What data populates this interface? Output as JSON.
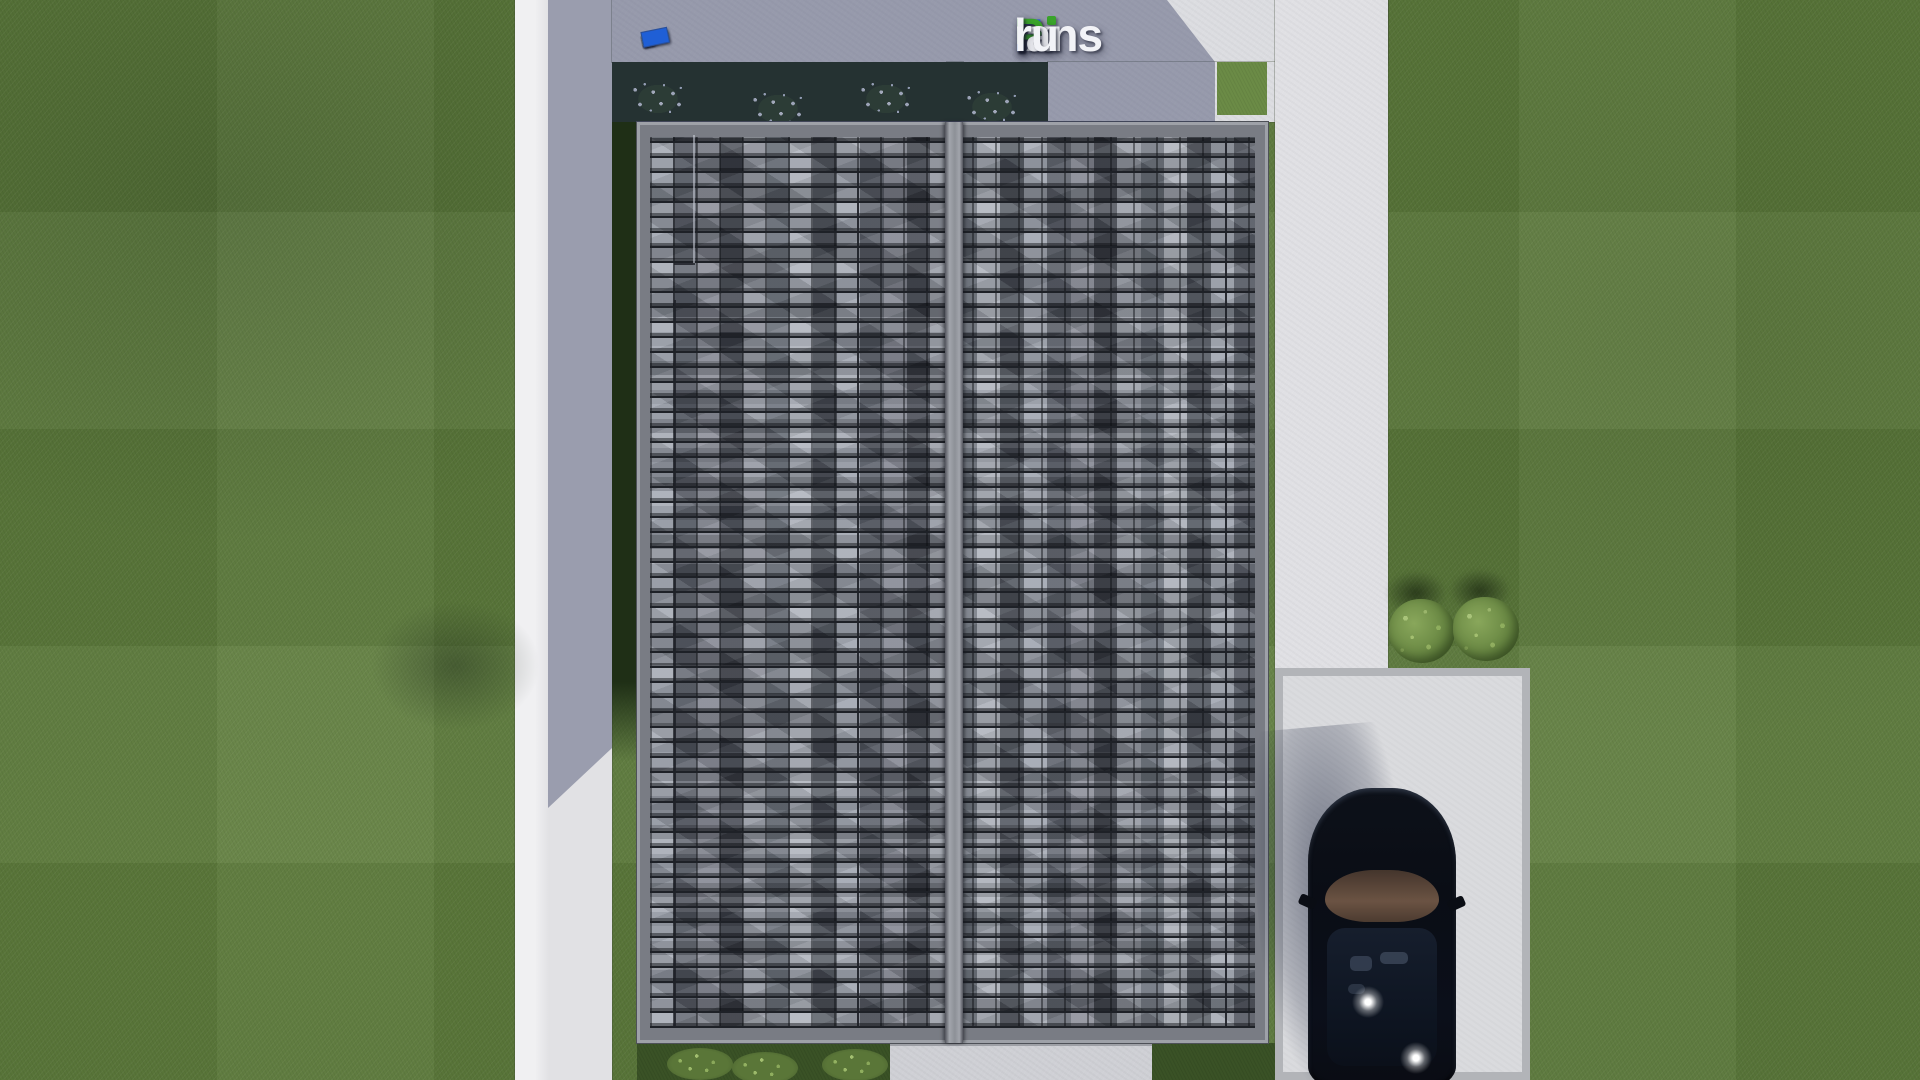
{
  "watermark": {
    "text": "FixPlans.ru",
    "parts": [
      {
        "text": "F",
        "color": "#2b62d9"
      },
      {
        "text": "ix",
        "color": "#f2f3f7"
      },
      {
        "text": "P",
        "color": "#3aa32b"
      },
      {
        "text": "lans",
        "color": "#f2f3f7"
      },
      {
        "text": ".",
        "color": "#2b6fe3"
      },
      {
        "text": "ru",
        "color": "#f2f3f7"
      }
    ],
    "i_dot_color": "#3aa32b"
  },
  "scale_bar": {
    "blocks": [
      {
        "w": 10,
        "h": 11,
        "color": "#e9ebef"
      },
      {
        "w": 10,
        "h": 11,
        "color": "#dde0e6"
      },
      {
        "w": 10,
        "h": 11,
        "color": "#e9ebef"
      },
      {
        "w": 10,
        "h": 11,
        "color": "#e2e5ea"
      },
      {
        "w": 11,
        "h": 11,
        "color": "#1f5fd6"
      },
      {
        "w": 24,
        "h": 11,
        "color": "#e9ebef"
      },
      {
        "w": 13,
        "h": 11,
        "color": "#dde0e6"
      },
      {
        "w": 13,
        "h": 11,
        "color": "#e9ebef"
      },
      {
        "w": 24,
        "h": 11,
        "color": "#e4e7ec"
      },
      {
        "w": 10,
        "h": 11,
        "color": "#e9ebef"
      },
      {
        "w": 27,
        "h": 11,
        "color": "#35a32b"
      },
      {
        "w": 13,
        "h": 11,
        "color": "#e9ebef"
      },
      {
        "w": 10,
        "h": 11,
        "color": "#dde0e6"
      },
      {
        "w": 10,
        "h": 10,
        "color": "#35a32b"
      },
      {
        "w": 27,
        "h": 16,
        "color": "#1f5fd6"
      }
    ]
  },
  "palette": {
    "grass_lit": "#5e7c3d",
    "grass_shadowed_bed": "#1f2f16",
    "concrete_lit": "#e2e2e5",
    "concrete_shadow_tint": "rgba(47,56,92,0.40)",
    "driveway": "#dadbde",
    "driveway_curb": "#b2b4b8",
    "roof_tile_light": "#a6abb5",
    "roof_tile_mid": "#7e828d",
    "roof_tile_dark": "#3f434d",
    "roof_ridge": "#8d9097",
    "car_body": "#0a0d15",
    "car_roof_tan": "#6b5343",
    "logo_blue": "#2b62d9",
    "logo_green": "#3aa32b",
    "logo_white": "#f2f3f7"
  }
}
